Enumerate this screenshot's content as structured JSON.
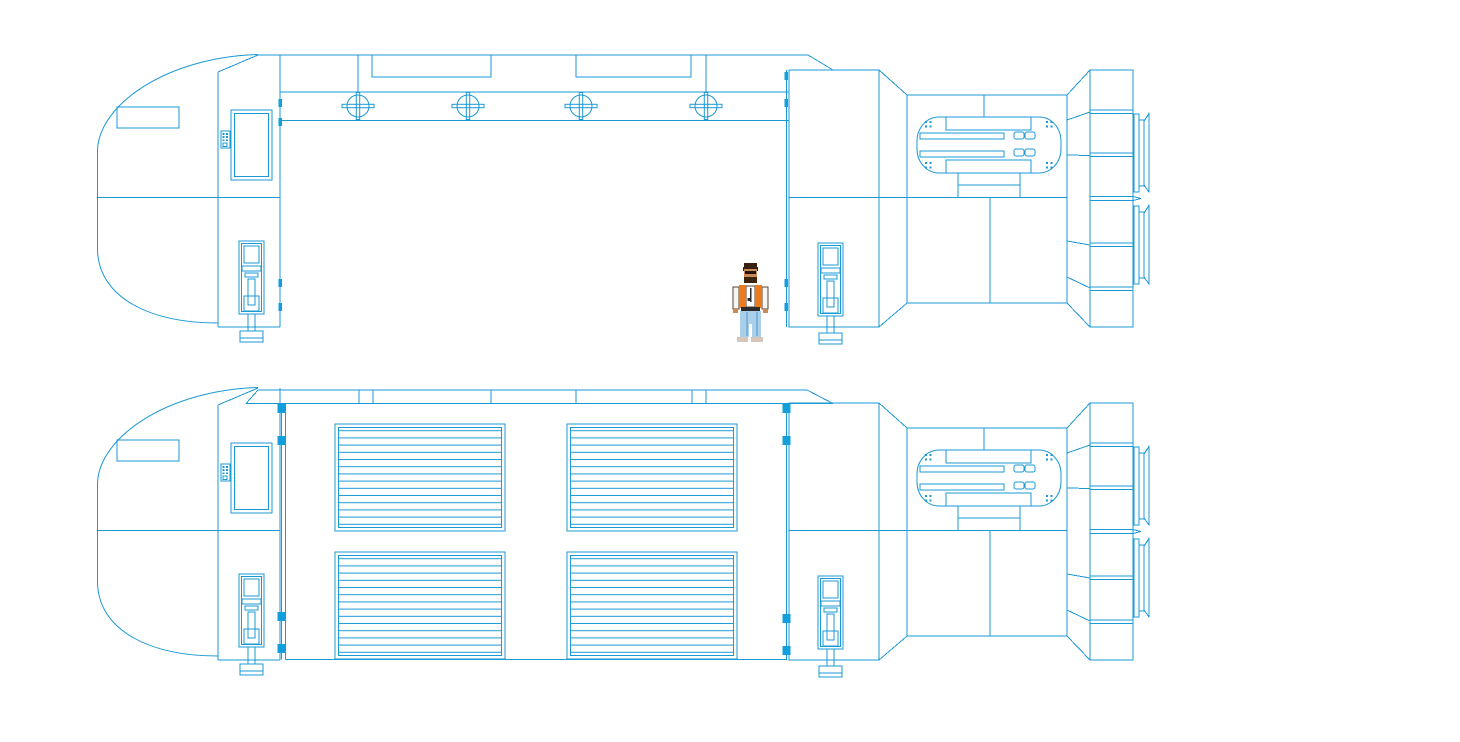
{
  "app": {
    "description": "Blueprint-style line drawing of a cargo spaceship shown in two side elevations, with a small pixel-art figure standing beside the open cargo bay of the upper view."
  },
  "palette": {
    "line_color": "#1b99d5",
    "hinge_fill": "#129fdc",
    "background": "#ffffff"
  },
  "drawing": {
    "views": [
      {
        "id": "upper-view",
        "bay_state": "open (doors removed, empty hold)",
        "dorsal_hatches": 4,
        "figure_present": true
      },
      {
        "id": "lower-view",
        "bay_state": "closed (louvered cargo doors)",
        "louver_panels": 4,
        "figure_present": false
      }
    ],
    "components": [
      "nose-section",
      "forward-bulkhead",
      "viewport-window",
      "control-panel",
      "dorsal-spine",
      "maintenance-hatch",
      "cargo-bay",
      "aft-bulkhead",
      "engine-machinery-unit",
      "thruster-mount-column",
      "exhaust-nozzle",
      "landing-strut",
      "door-hinge"
    ],
    "hatch_count": 4,
    "louver_panel_count": 4,
    "landing_struts_per_view": 2
  },
  "figure": {
    "name": "standing-person",
    "palette": {
      "hair": "#38220f",
      "skin": "#c98a57",
      "shades": "#241308",
      "beard": "#3a240f",
      "jacket": "#f8f6f1",
      "vest": "#e97d1d",
      "shirt": "#ffffff",
      "dark": "#2b2b2b",
      "jeans": "#a9cfe9",
      "jeans_shade": "#7fb2d8",
      "shoes": "#84523154"
    }
  }
}
